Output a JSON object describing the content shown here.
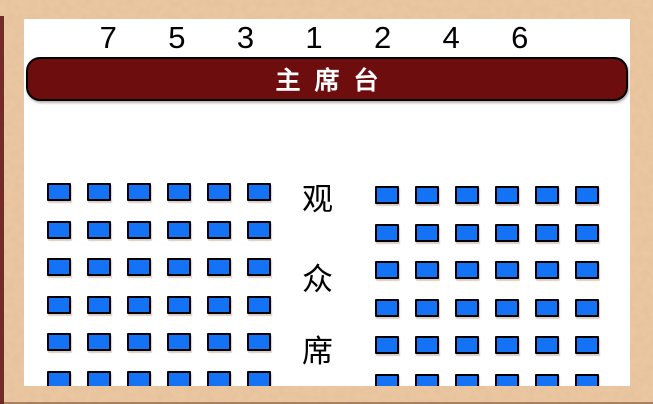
{
  "stage": {
    "label": "主席台"
  },
  "column_numbers": [
    "7",
    "5",
    "3",
    "1",
    "2",
    "4",
    "6"
  ],
  "audience_label": "观众席",
  "audience_label_chars": [
    "观",
    "众",
    "席"
  ],
  "seating": {
    "left_block": {
      "rows": 6,
      "cols": 6,
      "total_seats": 36
    },
    "right_block": {
      "rows": 6,
      "cols": 6,
      "total_seats": 36
    }
  },
  "colors": {
    "frame": "#edc9a2",
    "panel": "#ffffff",
    "edge_accent": "#5d1010",
    "stage_fill": "#6e0d0d",
    "stage_border": "#000000",
    "stage_text": "#ffffff",
    "seat_fill": "#1472f4",
    "seat_border": "#000000",
    "number_color": "#000000",
    "audience_text": "#000000"
  }
}
